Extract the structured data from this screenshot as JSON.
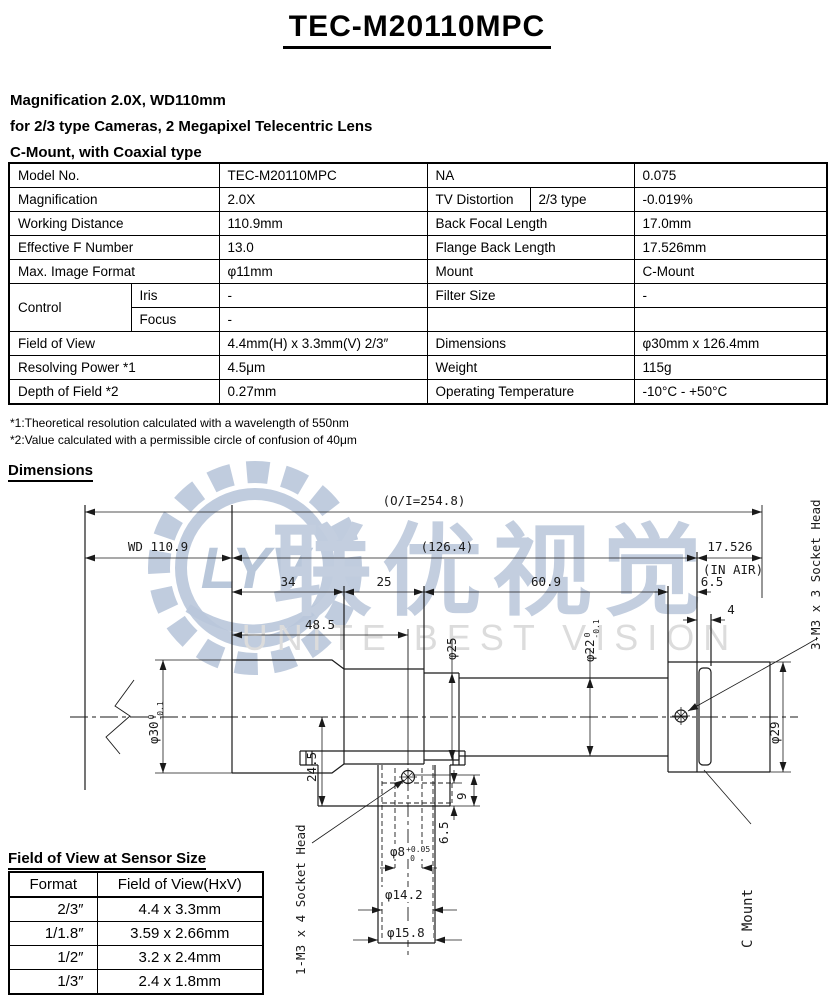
{
  "title": "TEC-M20110MPC",
  "intro_lines": [
    "Magnification 2.0X, WD110mm",
    "for 2/3 type Cameras, 2 Megapixel Telecentric Lens",
    "C-Mount, with Coaxial type"
  ],
  "spec": {
    "model_no": {
      "label": "Model No.",
      "value": "TEC-M20110MPC"
    },
    "na": {
      "label": "NA",
      "value": "0.075"
    },
    "magnification": {
      "label": "Magnification",
      "value": "2.0X"
    },
    "tv_distortion": {
      "label": "TV Distortion",
      "sub": "2/3 type",
      "value": "-0.019%"
    },
    "working_distance": {
      "label": "Working Distance",
      "value": "110.9mm"
    },
    "back_focal_length": {
      "label": "Back Focal Length",
      "value": "17.0mm"
    },
    "effective_f_number": {
      "label": "Effective F Number",
      "value": "13.0"
    },
    "flange_back_length": {
      "label": "Flange Back Length",
      "value": "17.526mm"
    },
    "max_image_format": {
      "label": "Max. Image Format",
      "value": "φ11mm"
    },
    "mount": {
      "label": "Mount",
      "value": "C-Mount"
    },
    "control": {
      "label": "Control",
      "iris_label": "Iris",
      "iris_value": "-",
      "focus_label": "Focus",
      "focus_value": "-"
    },
    "filter_size": {
      "label": "Filter Size",
      "value": "-"
    },
    "field_of_view": {
      "label": "Field of View",
      "value": "4.4mm(H) x 3.3mm(V) 2/3″"
    },
    "dimensions": {
      "label": "Dimensions",
      "value": "φ30mm x 126.4mm"
    },
    "resolving_power": {
      "label": "Resolving Power *1",
      "value": "4.5μm"
    },
    "weight": {
      "label": "Weight",
      "value": "115g"
    },
    "depth_of_field": {
      "label": "Depth of Field *2",
      "value": "0.27mm"
    },
    "operating_temperature": {
      "label": "Operating Temperature",
      "value": "-10°C - +50°C"
    }
  },
  "footnotes": [
    "*1:Theoretical resolution calculated with a wavelength of 550nm",
    "*2:Value calculated with a permissible circle of confusion of 40μm"
  ],
  "dimensions_section": {
    "heading": "Dimensions"
  },
  "drawing": {
    "oi": "(O/I=254.8)",
    "wd": "WD 110.9",
    "mid_len": "(126.4)",
    "ffd": "17.526",
    "in_air": "(IN AIR)",
    "d34": "34",
    "d25": "25",
    "d609": "60.9",
    "d65": "6.5",
    "d4": "4",
    "d485": "48.5",
    "d245": "24.5",
    "v9": "9",
    "v65": "6.5",
    "phi30": {
      "main": "φ30",
      "tol_top": "0",
      "tol_bot": "-0.1"
    },
    "phi25": "φ25",
    "phi22": {
      "main": "φ22",
      "tol_top": "0",
      "tol_bot": "-0.1"
    },
    "phi29": "φ29",
    "phi8": {
      "main": "φ8",
      "tol_top": "+0.05",
      "tol_bot": "0"
    },
    "phi142": "φ14.2",
    "phi158": "φ15.8",
    "socket3": "3-M3 x 3 Socket Head",
    "socket1": "1-M3 x 4 Socket Head",
    "cmount": "C Mount"
  },
  "watermark": {
    "monogram": "LYV",
    "chinese": "联优视觉",
    "english": "UNITE BEST VISION",
    "color": "#b9c7da",
    "english_color": "#dcdcdc"
  },
  "fov_section": {
    "heading": "Field of View at Sensor Size",
    "headers": [
      "Format",
      "Field of View(HxV)"
    ],
    "rows": [
      [
        "2/3″",
        "4.4 x 3.3mm"
      ],
      [
        "1/1.8″",
        "3.59 x 2.66mm"
      ],
      [
        "1/2″",
        "3.2 x 2.4mm"
      ],
      [
        "1/3″",
        "2.4 x 1.8mm"
      ]
    ]
  }
}
